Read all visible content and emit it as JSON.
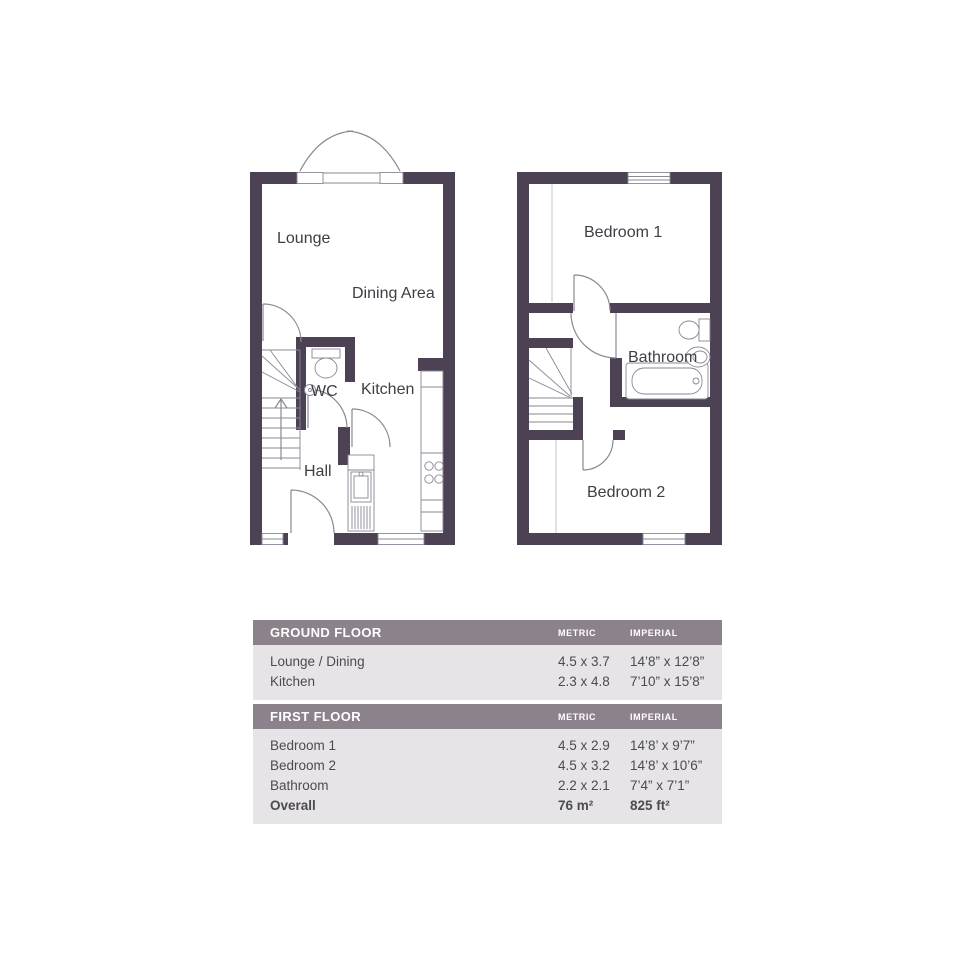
{
  "colors": {
    "wall": "#4d4254",
    "line": "#8b8795",
    "light_line": "#c6c3cc",
    "label": "#3e3e45",
    "header_bg": "#8c828b",
    "header_text": "#ffffff",
    "row_bg": "#e6e4e6",
    "row_text": "#4b4b50"
  },
  "plans": {
    "ground": {
      "labels": {
        "lounge": "Lounge",
        "dining": "Dining Area",
        "wc": "WC",
        "kitchen": "Kitchen",
        "hall": "Hall"
      }
    },
    "first": {
      "labels": {
        "bedroom1": "Bedroom 1",
        "bathroom": "Bathroom",
        "bedroom2": "Bedroom 2"
      }
    }
  },
  "table": {
    "sections": [
      {
        "title": "GROUND FLOOR",
        "metric_label": "METRIC",
        "imperial_label": "IMPERIAL",
        "rows": [
          {
            "name": "Lounge / Dining",
            "metric": "4.5 x 3.7",
            "imperial": "14’8” x 12’8”"
          },
          {
            "name": "Kitchen",
            "metric": "2.3 x 4.8",
            "imperial": "7’10” x 15’8”"
          }
        ]
      },
      {
        "title": "FIRST FLOOR",
        "metric_label": "METRIC",
        "imperial_label": "IMPERIAL",
        "rows": [
          {
            "name": "Bedroom 1",
            "metric": "4.5 x 2.9",
            "imperial": "14’8’ x 9’7”"
          },
          {
            "name": "Bedroom 2",
            "metric": "4.5 x 3.2",
            "imperial": "14’8’ x 10’6”"
          },
          {
            "name": "Bathroom",
            "metric": "2.2 x 2.1",
            "imperial": "7’4” x 7’1”"
          },
          {
            "name": "Overall",
            "metric": "76 m²",
            "imperial": "825 ft²"
          }
        ]
      }
    ]
  }
}
